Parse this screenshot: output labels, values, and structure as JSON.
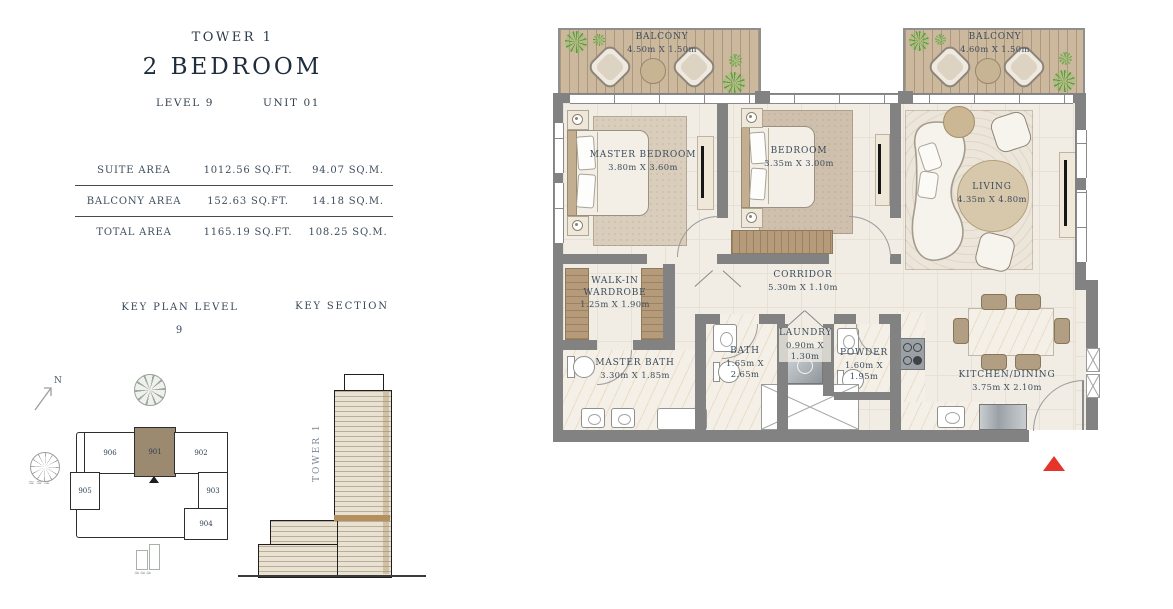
{
  "header": {
    "tower": "TOWER 1",
    "title": "2 BEDROOM",
    "level": "LEVEL 9",
    "unit": "UNIT 01"
  },
  "area_table": {
    "rows": [
      {
        "label": "SUITE AREA",
        "sqft": "1012.56 SQ.FT.",
        "sqm": "94.07 SQ.M."
      },
      {
        "label": "BALCONY AREA",
        "sqft": "152.63 SQ.FT.",
        "sqm": "14.18 SQ.M."
      },
      {
        "label": "TOTAL AREA",
        "sqft": "1165.19 SQ.FT.",
        "sqm": "108.25 SQ.M."
      }
    ]
  },
  "key_plan": {
    "title": "KEY PLAN LEVEL",
    "level": "9",
    "north": "N",
    "units": {
      "u906": "906",
      "u901": "901",
      "u902": "902",
      "u905": "905",
      "u903": "903",
      "u904": "904"
    },
    "highlighted_unit": "901",
    "highlight_color": "#9b8a70"
  },
  "key_section": {
    "title": "KEY SECTION",
    "tower_label": "TOWER 1"
  },
  "floor_plan": {
    "rooms": {
      "balcony_left": {
        "name": "BALCONY",
        "dims": "4.50m X 1.50m"
      },
      "balcony_right": {
        "name": "BALCONY",
        "dims": "4.60m X 1.50m"
      },
      "master_bedroom": {
        "name": "MASTER BEDROOM",
        "dims": "3.80m X 3.60m"
      },
      "bedroom": {
        "name": "BEDROOM",
        "dims": "3.35m X 3.00m"
      },
      "living": {
        "name": "LIVING",
        "dims": "4.35m X 4.80m"
      },
      "walk_in_wardrobe": {
        "name": "WALK-IN WARDROBE",
        "dims": "1.25m X 1.90m"
      },
      "corridor": {
        "name": "CORRIDOR",
        "dims": "5.30m X 1.10m"
      },
      "master_bath": {
        "name": "MASTER BATH",
        "dims": "3.30m X 1.85m"
      },
      "bath": {
        "name": "BATH",
        "dims": "1.65m X 2.65m"
      },
      "laundry": {
        "name": "LAUNDRY",
        "dims": "0.90m X 1.30m"
      },
      "powder": {
        "name": "POWDER",
        "dims": "1.60m X 1.95m"
      },
      "kitchen_dining": {
        "name": "KITCHEN/DINING",
        "dims": "3.75m X 2.10m"
      }
    },
    "colors": {
      "wall": "#828282",
      "floor": "#f1ede4",
      "deck": "#cbb89d",
      "wood": "#b59b79",
      "entrance_arrow": "#e5352b"
    }
  }
}
